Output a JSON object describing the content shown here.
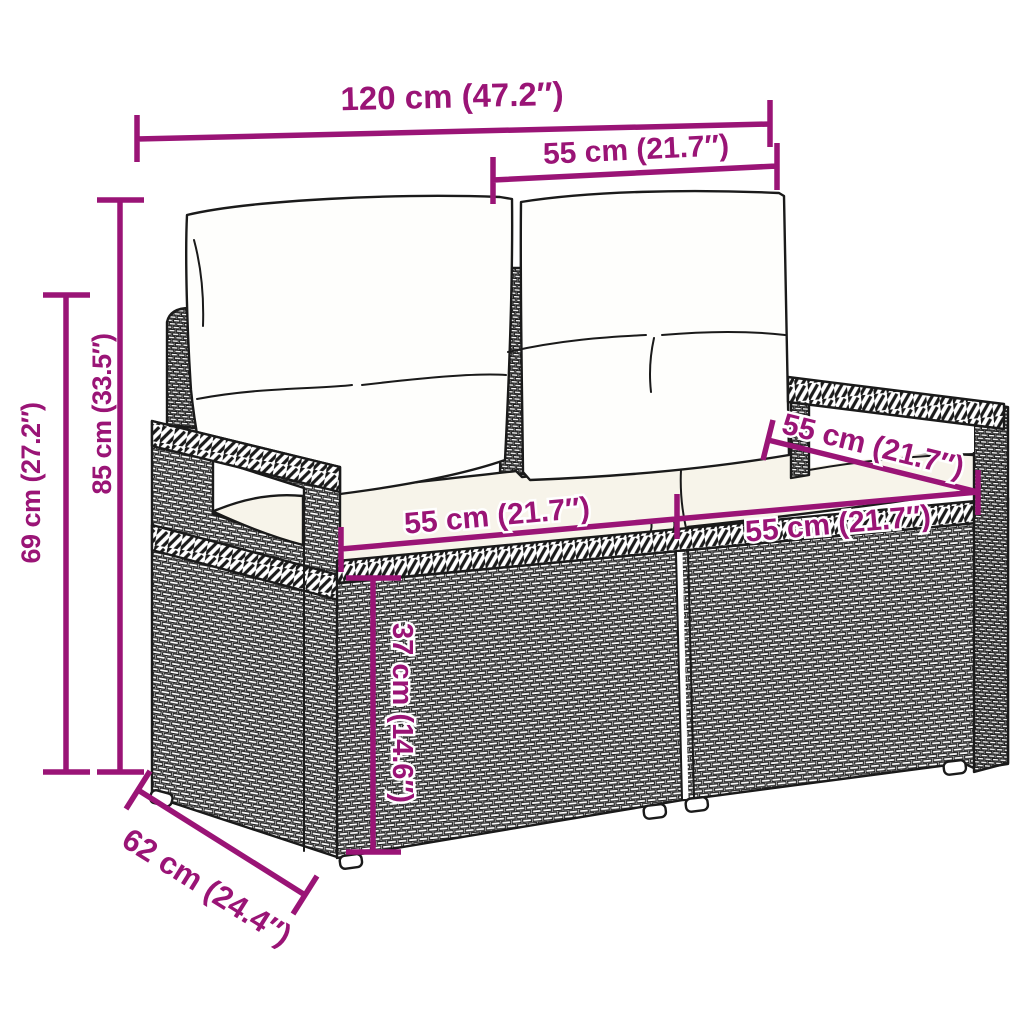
{
  "diagram": {
    "subject": "rattan-garden-2-seater-bench-with-cushions",
    "colors": {
      "dimension": "#9A1476",
      "outline": "#1A1A1A",
      "cushion_fill": "#F7F4EA",
      "background": "#FFFFFF"
    },
    "dimensions": {
      "total_width": "120 cm (47.2″)",
      "backrest_width": "55 cm (21.7″)",
      "total_height": "85 cm (33.5″)",
      "armrest_height": "69 cm (27.2″)",
      "seat_width_left": "55 cm (21.7″)",
      "seat_width_right": "55 cm (21.7″)",
      "seat_depth_top": "55 cm (21.7″)",
      "seat_height": "37 cm (14.6″)",
      "total_depth": "62 cm (24.4″)"
    }
  }
}
